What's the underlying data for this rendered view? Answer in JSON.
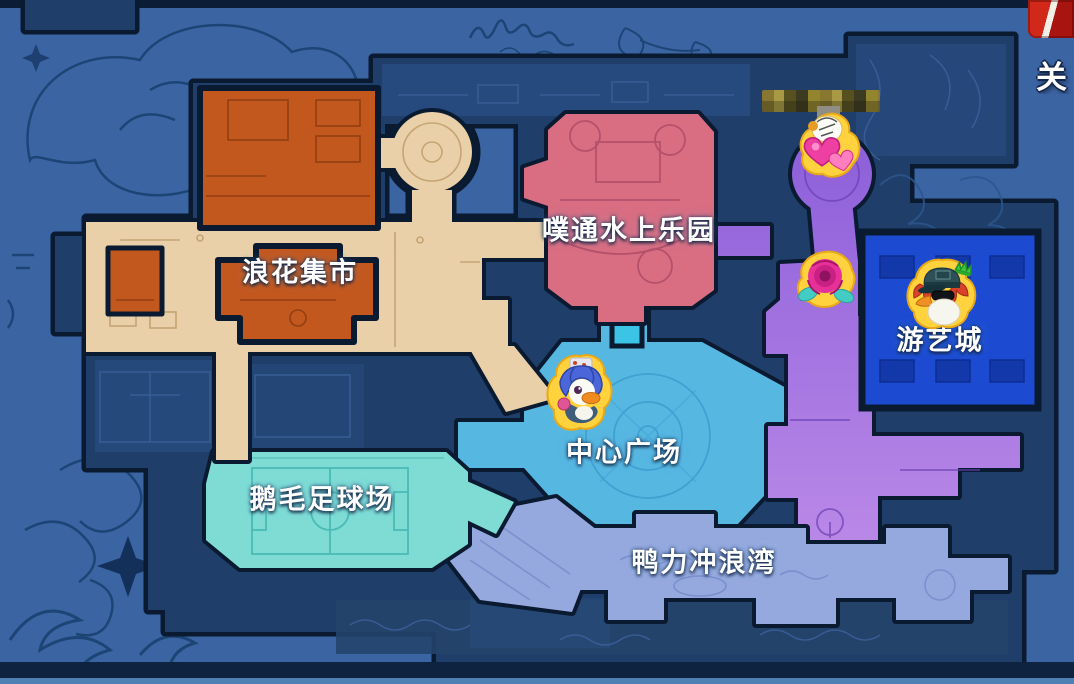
{
  "ui": {
    "close_button_label": "关闭"
  },
  "map": {
    "regions": [
      {
        "id": "langhua-market",
        "label": "浪花集市",
        "color": "#c3581f"
      },
      {
        "id": "putong-water-park",
        "label": "噗通水上乐园",
        "color": "#d96d82"
      },
      {
        "id": "central-plaza",
        "label": "中心广场",
        "color": "#56b7e1"
      },
      {
        "id": "arcade-city",
        "label": "游艺城",
        "color": "#1c4bd2"
      },
      {
        "id": "goose-feather-football-field",
        "label": "鹅毛足球场",
        "color": "#7edcd5"
      },
      {
        "id": "duck-surf-bay",
        "label": "鸭力冲浪湾",
        "color": "#96a9de"
      }
    ],
    "markers": [
      {
        "id": "player-marker-top",
        "icon": "duck-with-hearts-icon"
      },
      {
        "id": "rose-marker",
        "icon": "rose-icon"
      },
      {
        "id": "player-marker-plaza",
        "icon": "blue-haired-duck-icon"
      },
      {
        "id": "player-marker-arcade",
        "icon": "capped-duck-with-crown-icon"
      }
    ],
    "censored": {
      "player_name_hidden": true
    }
  },
  "palette": {
    "background": "#3b64a3",
    "map_base": "#1f3e6a",
    "outline": "#0a1a30",
    "marker_ring": "#ffd23e",
    "purple_path_top": "#8a5cd8",
    "purple_path_bottom": "#bb8ae8",
    "tan_path": "#ead0a8",
    "mosaic_tone": "#877730",
    "corner_button_red": "#c81f14"
  }
}
